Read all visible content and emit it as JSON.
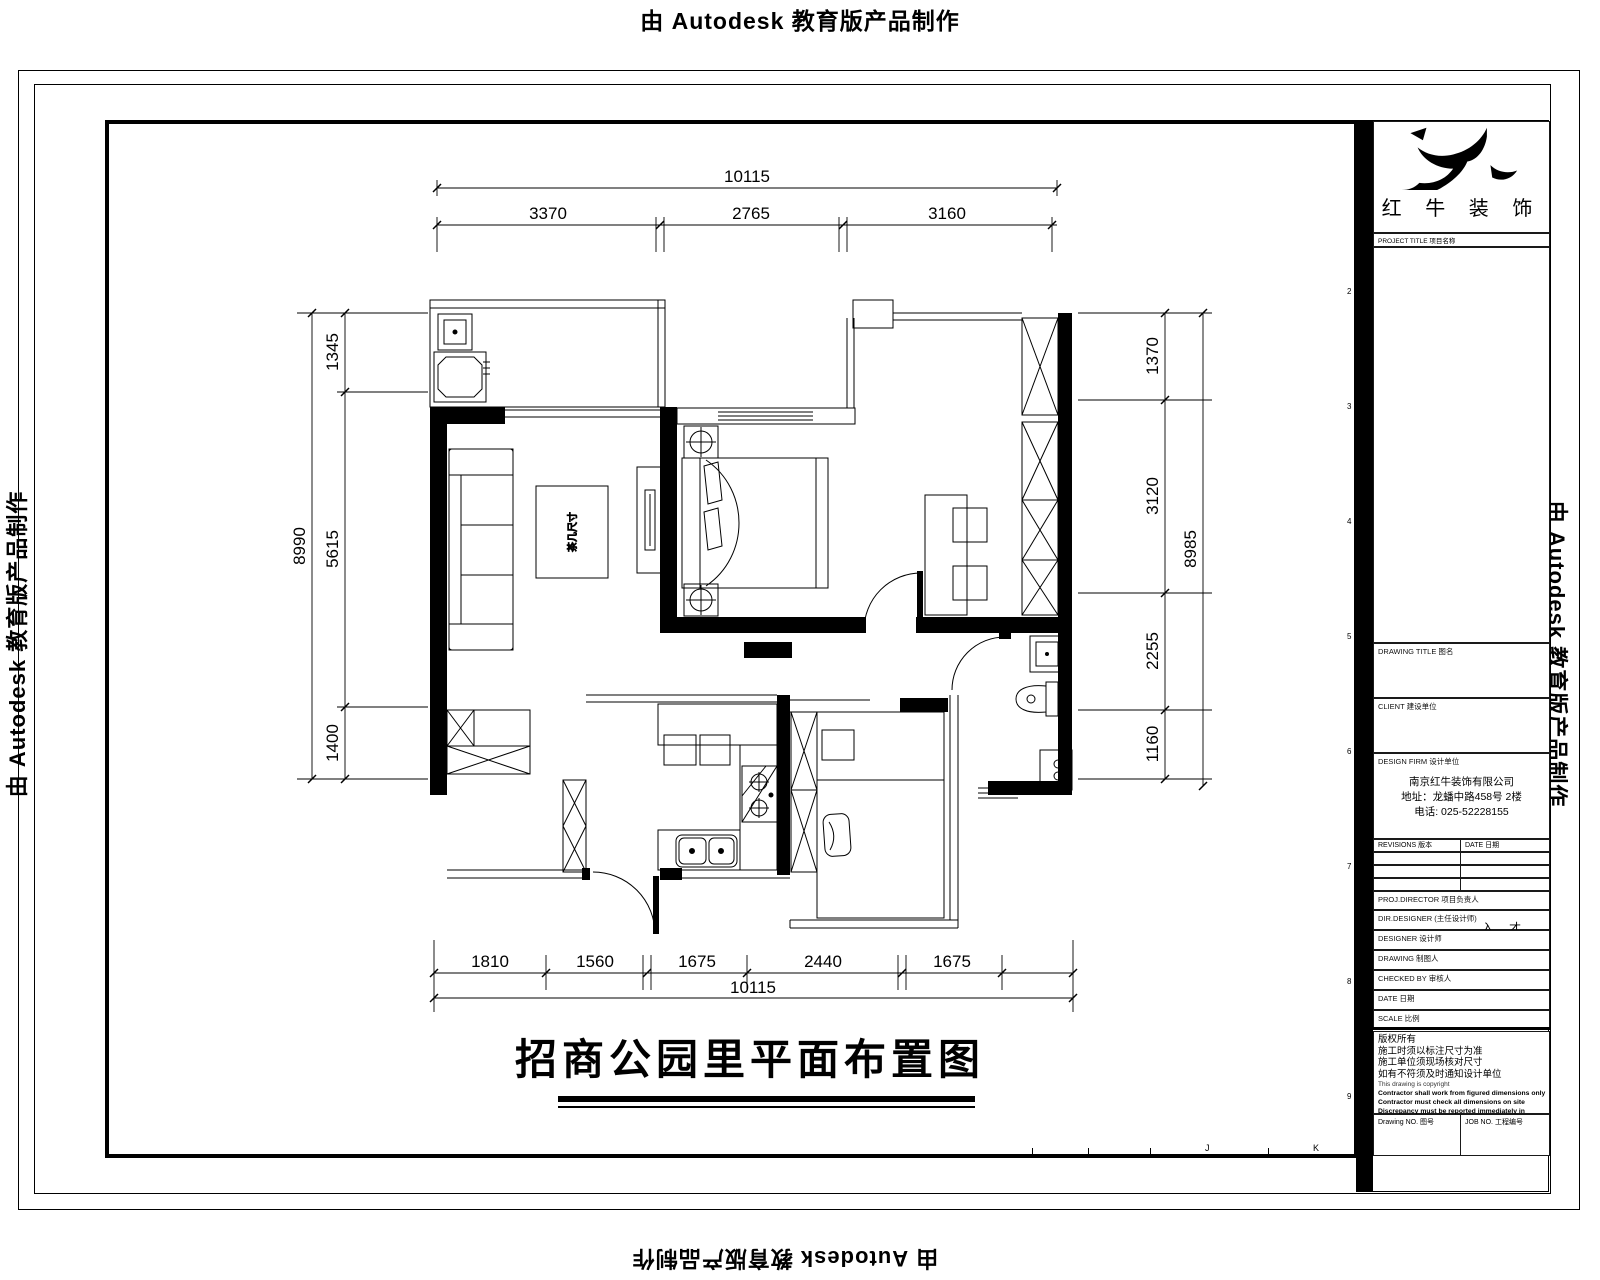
{
  "watermark": {
    "prefix": "由",
    "brand": "Autodesk",
    "suffix": "教育版产品制作"
  },
  "sheet": {
    "zone_numbers_right": [
      "2",
      "3",
      "4",
      "5",
      "6",
      "7",
      "8",
      "9"
    ],
    "zone_letters_bottom": [
      "J",
      "K"
    ]
  },
  "title_block": {
    "logo_text": "红 牛 装 饰",
    "logo_sublabel": "PROJECT TITLE 项目名称",
    "drawing_title_label": "DRAWING TITLE 图名",
    "client_label": "CLIENT 建设单位",
    "design_firm_label": "DESIGN FIRM 设计单位",
    "firm": {
      "name": "南京红牛装饰有限公司",
      "address": "地址：龙蟠中路458号 2楼",
      "phone": "电话: 025-52228155"
    },
    "revisions_label": "REVISIONS 版本",
    "revisions_date_label": "DATE 日期",
    "fields": [
      {
        "label": "PROJ.DIRECTOR 项目负责人",
        "value": ""
      },
      {
        "label": "DIR.DESIGNER (主任设计师)",
        "value": "入 才"
      },
      {
        "label": "DESIGNER 设计师",
        "value": ""
      },
      {
        "label": "DRAWING 制图人",
        "value": ""
      },
      {
        "label": "CHECKED BY 审核人",
        "value": ""
      },
      {
        "label": "DATE 日期",
        "value": ""
      },
      {
        "label": "SCALE 比例",
        "value": ""
      }
    ],
    "notes_cn": [
      "版权所有",
      "施工时须以标注尺寸为准",
      "施工单位须现场核对尺寸",
      "如有不符须及时通知设计单位"
    ],
    "notes_en": [
      "This drawing is copyright",
      "Contractor shall work from figured dimensions only",
      "Contractor must check all dimensions on site",
      "Discrepancy must be reported immediately in advance"
    ],
    "drawing_no_label": "Drawing NO. 图号",
    "job_no_label": "JOB NO. 工程编号"
  },
  "plan": {
    "title": "招商公园里平面布置图",
    "coffee_table_label": "茶几尺寸",
    "dims": {
      "top_overall": "10115",
      "top_segments": [
        "3370",
        "2765",
        "3160"
      ],
      "bottom_overall": "10115",
      "bottom_segments": [
        "1810",
        "1560",
        "1675",
        "2440",
        "1675"
      ],
      "left_overall": "8990",
      "left_segments": [
        "1345",
        "5615",
        "1400"
      ],
      "right_overall": "8985",
      "right_segments": [
        "1370",
        "3120",
        "2255",
        "1160"
      ]
    }
  }
}
